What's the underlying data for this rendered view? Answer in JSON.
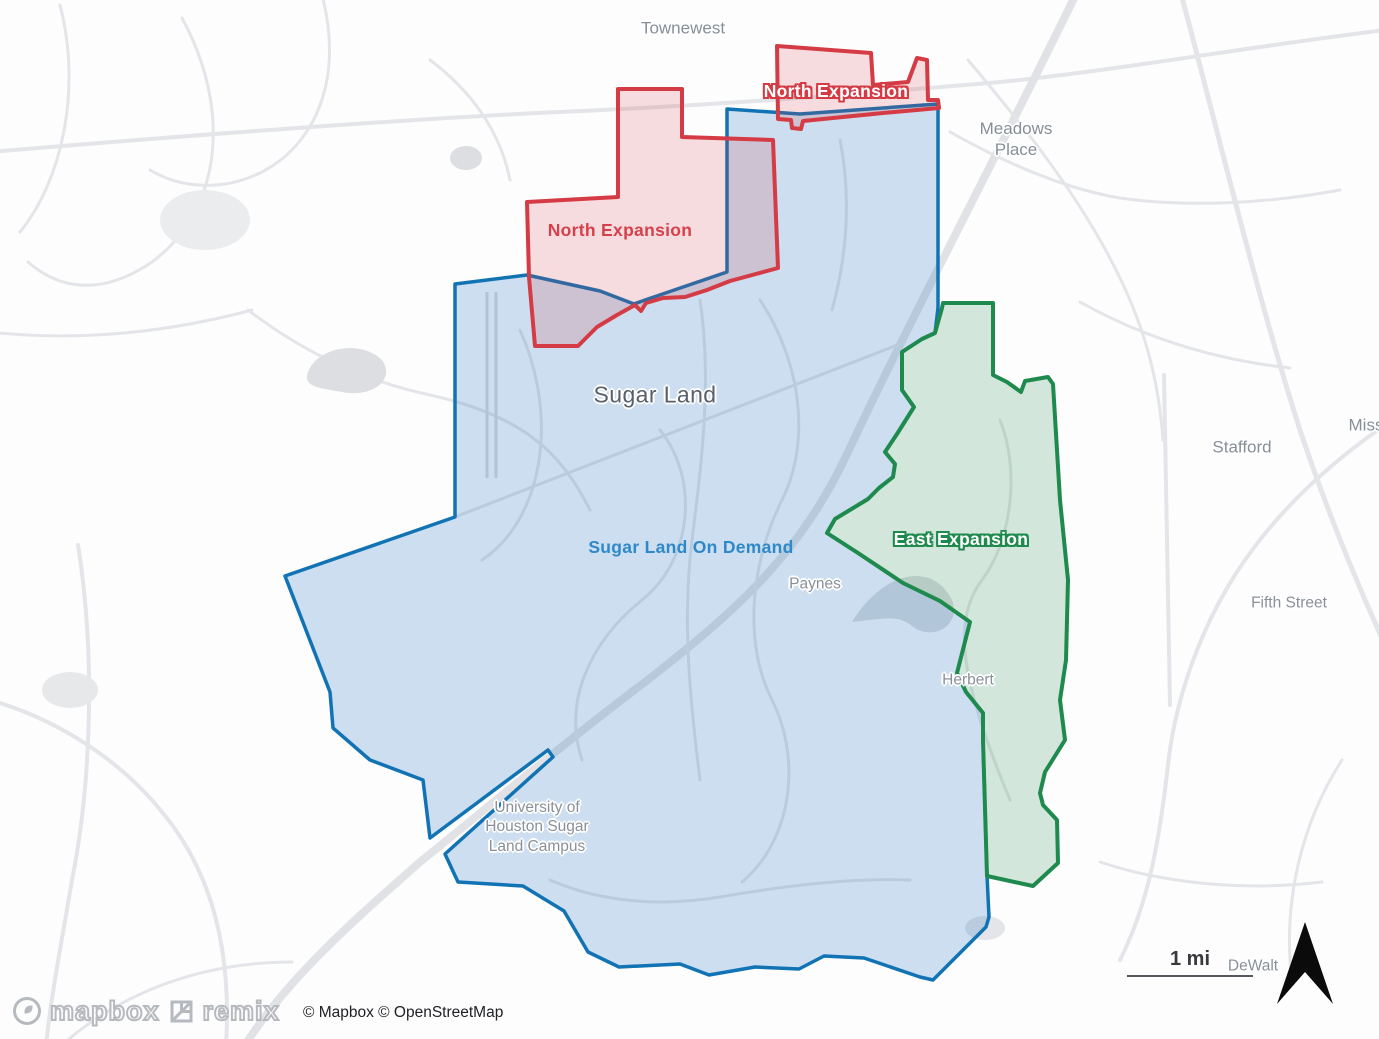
{
  "zones": [
    {
      "id": "sugar-land-on-demand",
      "name": "Sugar Land On Demand",
      "stroke": "#1173b4",
      "fill": "rgba(58,132,195,0.25)",
      "stroke_width": 3.5,
      "points": "455,284 527,275 600,291 634,304 648,299 727,272 727,109 800,114 938,104 938,308 935,333 922,339 902,352 902,390 914,407 897,434 885,452 895,464 893,477 879,488 868,499 835,519 827,533 858,553 903,583 940,601 970,622 957,673 966,692 983,713 983,740 987,875 989,917 986,927 933,980 920,977 864,958 824,956 799,969 755,967 709,975 680,964 619,967 588,952 564,911 523,886 458,882 445,854 553,757 548,750 430,838 423,780 370,760 333,728 330,692 285,576 455,517",
      "label": {
        "text": "Sugar Land On Demand",
        "x": 691,
        "y": 548,
        "style": "blue"
      }
    },
    {
      "id": "east-expansion",
      "name": "East Expansion",
      "stroke": "#1e8a4d",
      "fill": "rgba(46,139,87,0.20)",
      "stroke_width": 4,
      "points": "943,303 993,303 993,375 1007,382 1021,392 1025,381 1048,377 1053,384 1060,500 1068,580 1066,660 1060,700 1065,740 1045,772 1040,793 1043,805 1057,820 1058,863 1033,886 987,876 983,740 983,713 966,692 957,673 970,622 940,601 903,583 858,553 827,533 835,519 868,499 879,488 893,477 895,464 885,452 897,434 914,407 902,390 902,352 922,339 935,333 942,308",
      "label": {
        "text": "East Expansion",
        "x": 961,
        "y": 540,
        "style": "green"
      }
    },
    {
      "id": "north-expansion-main",
      "name": "North Expansion",
      "stroke": "#d43b44",
      "fill": "rgba(214,59,68,0.17)",
      "stroke_width": 4,
      "points": "618,89 682,89 682,137 773,140 778,268 730,281 707,290 685,297 663,298 646,303 641,311 635,305 617,315 597,327 585,339 578,346 535,346 529,277 527,202 618,197",
      "label": {
        "text": "North Expansion",
        "x": 620,
        "y": 231,
        "style": "red"
      }
    },
    {
      "id": "north-expansion-upper",
      "name": "North Expansion",
      "stroke": "#d43b44",
      "fill": "rgba(214,59,68,0.17)",
      "stroke_width": 4,
      "points": "777,46 871,53 873,85 908,82 917,58 927,60 928,100 938,100 939,108 883,113 803,121 801,129 792,128 791,120 778,119",
      "label": {
        "text": "North Expansion",
        "x": 836,
        "y": 92,
        "style": "red-halo"
      }
    }
  ],
  "place_labels": [
    {
      "id": "townewest",
      "text": "Townewest",
      "x": 683,
      "y": 28,
      "kind": "town"
    },
    {
      "id": "meadows-place",
      "text": "Meadows\nPlace",
      "x": 1016,
      "y": 139,
      "kind": "town"
    },
    {
      "id": "sugar-land",
      "text": "Sugar Land",
      "x": 655,
      "y": 395,
      "kind": "city"
    },
    {
      "id": "stafford",
      "text": "Stafford",
      "x": 1242,
      "y": 447,
      "kind": "town"
    },
    {
      "id": "missouri-city-clipped",
      "text": "Miss",
      "x": 1366,
      "y": 425,
      "kind": "town"
    },
    {
      "id": "fifth-street",
      "text": "Fifth Street",
      "x": 1289,
      "y": 603,
      "kind": "town-sm"
    },
    {
      "id": "paynes",
      "text": "Paynes",
      "x": 815,
      "y": 584,
      "kind": "town-sm"
    },
    {
      "id": "herbert",
      "text": "Herbert",
      "x": 968,
      "y": 680,
      "kind": "town-sm"
    },
    {
      "id": "uh-sugar-land-campus",
      "text": "University of\nHouston Sugar\nLand Campus",
      "x": 537,
      "y": 827,
      "kind": "town-sm"
    },
    {
      "id": "dewalt",
      "text": "DeWalt",
      "x": 1253,
      "y": 966,
      "kind": "town-sm"
    }
  ],
  "controls": {
    "scale_label": "1 mi"
  },
  "attribution": {
    "text": "© Mapbox © OpenStreetMap"
  },
  "logos": {
    "mapbox_label": "mapbox",
    "remix_label": "remix"
  },
  "colors": {
    "zone_blue": "#1173b4",
    "zone_red": "#d43b44",
    "zone_green": "#1e8a4d"
  }
}
